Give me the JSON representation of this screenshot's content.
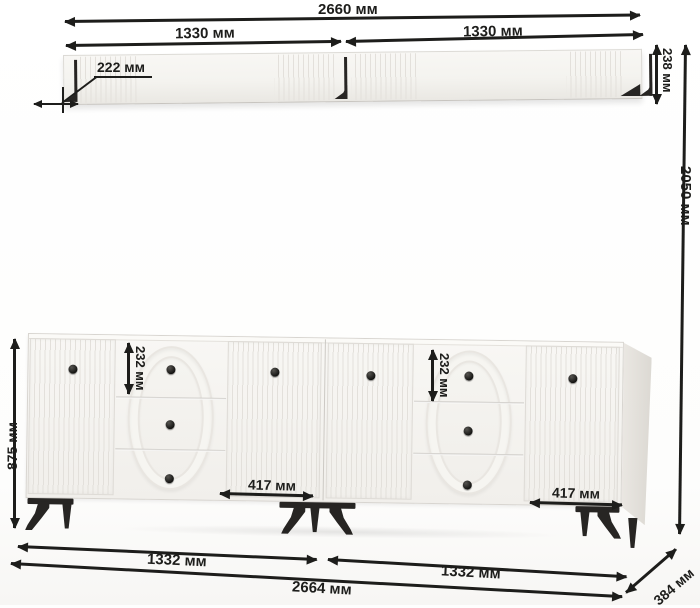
{
  "diagram_labels": {
    "shelf_total_width": "2660 мм",
    "shelf_left_width": "1330 мм",
    "shelf_right_width": "1330 мм",
    "shelf_depth": "222 мм",
    "shelf_height": "238 мм",
    "overall_height": "2050 мм",
    "cabinet_height": "875 мм",
    "cabinet_drawer_height_left": "232 мм",
    "cabinet_drawer_height_right": "232 мм",
    "cabinet_door_width_left": "417 мм",
    "cabinet_door_width_right": "417 мм",
    "cabinet_left_width": "1332 мм",
    "cabinet_right_width": "1332 мм",
    "cabinet_total_width": "2664 мм",
    "cabinet_depth": "384 мм"
  },
  "colors": {
    "ink": "#1d1d1b",
    "furniture_fill": "#f6f5f2",
    "legs_and_brackets": "#272523"
  }
}
